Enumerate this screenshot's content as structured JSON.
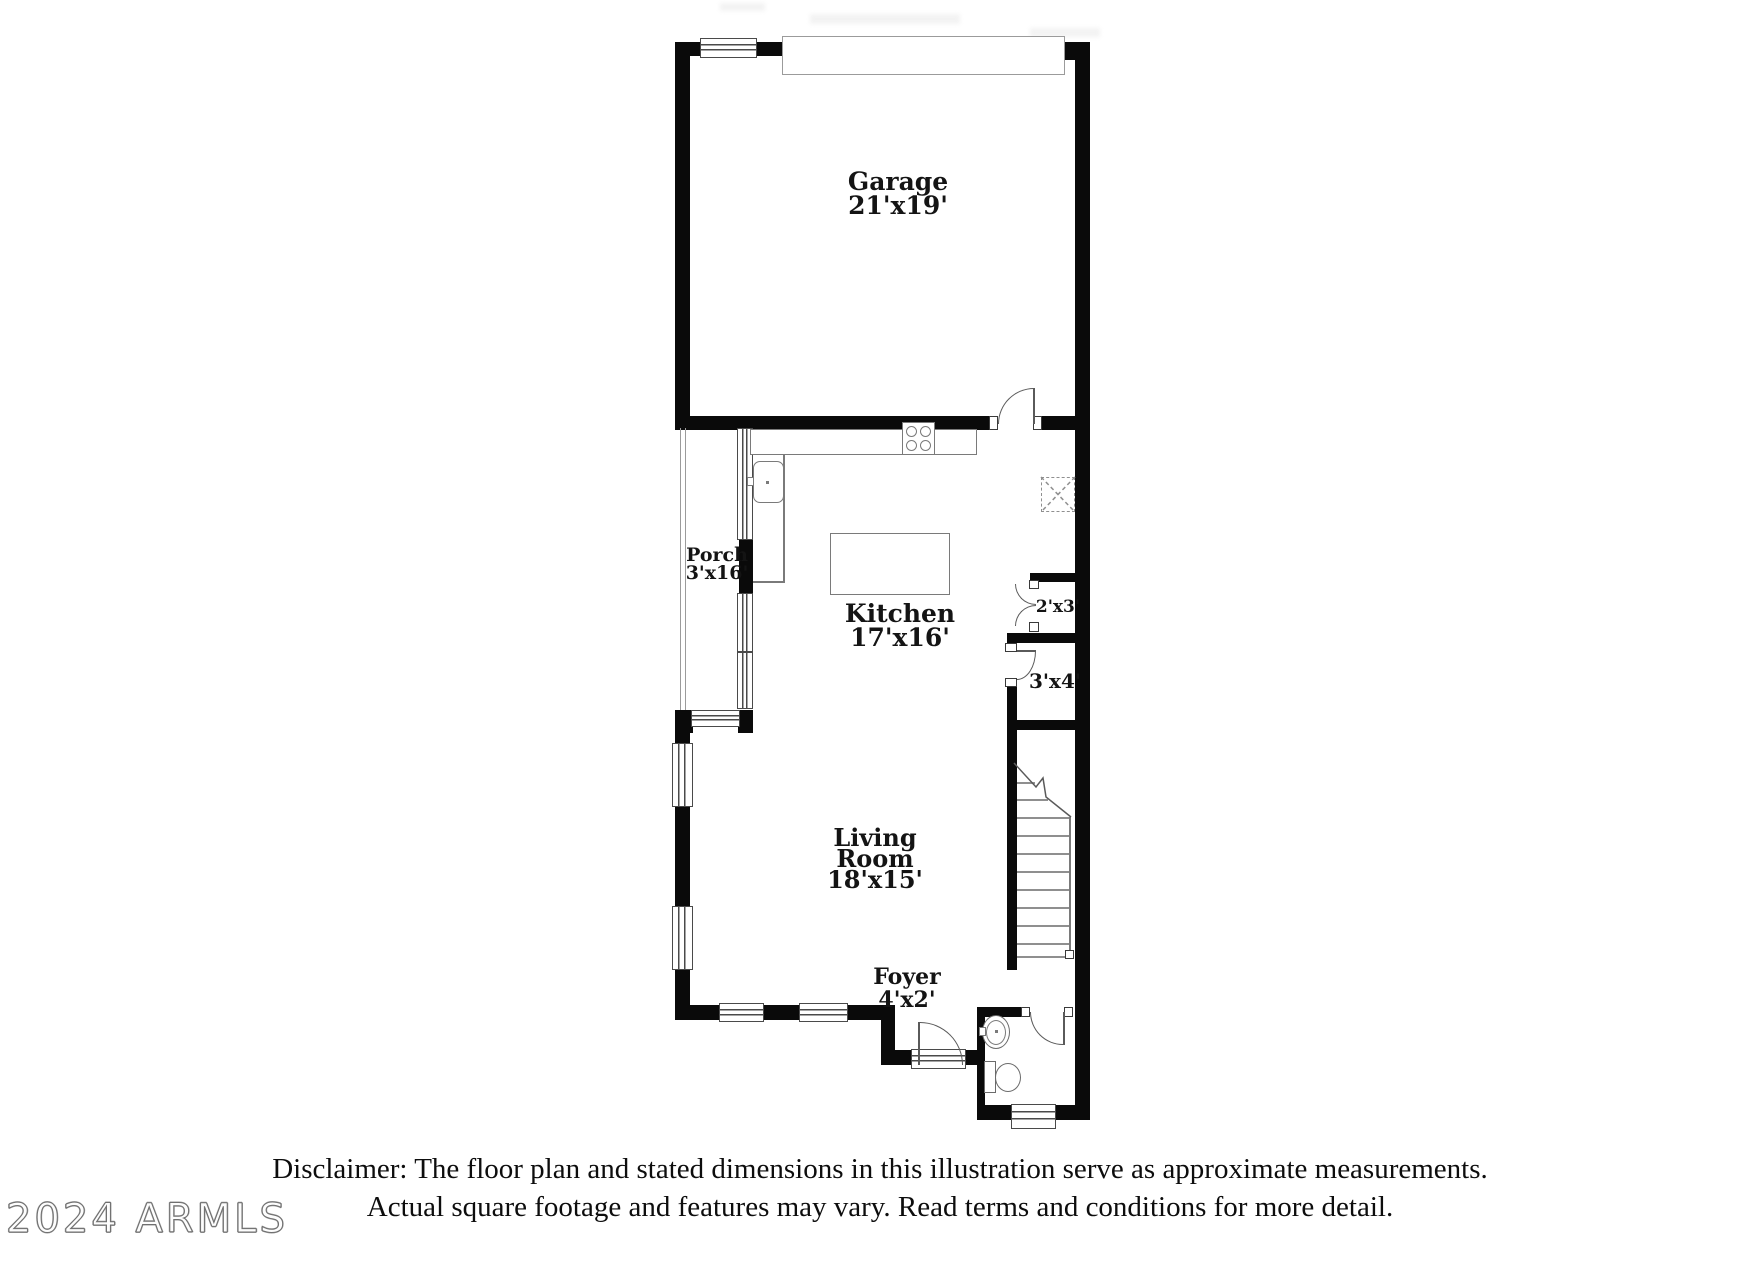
{
  "rooms": {
    "garage": {
      "label": "Garage",
      "dims": "21'x19'"
    },
    "kitchen": {
      "label": "Kitchen",
      "dims": "17'x16'"
    },
    "porch": {
      "label": "Porch",
      "dims": "3'x16'"
    },
    "living_room": {
      "line1": "Living",
      "line2": "Room",
      "dims": "18'x15'"
    },
    "foyer": {
      "label": "Foyer",
      "dims": "4'x2'"
    },
    "closet_hall": {
      "dims": "2'x3'"
    },
    "closet_under_stairs": {
      "dims": "3'x4'"
    }
  },
  "disclaimer": {
    "line1": "Disclaimer: The floor plan and stated dimensions in this illustration serve as approximate measurements.",
    "line2": "Actual square footage and features may vary. Read terms and conditions for more detail."
  },
  "watermark": {
    "text": "2024 ARMLS"
  },
  "colors": {
    "wall": "#0a0a0a",
    "fixture_line": "#7a7a7a",
    "text": "#141414"
  }
}
